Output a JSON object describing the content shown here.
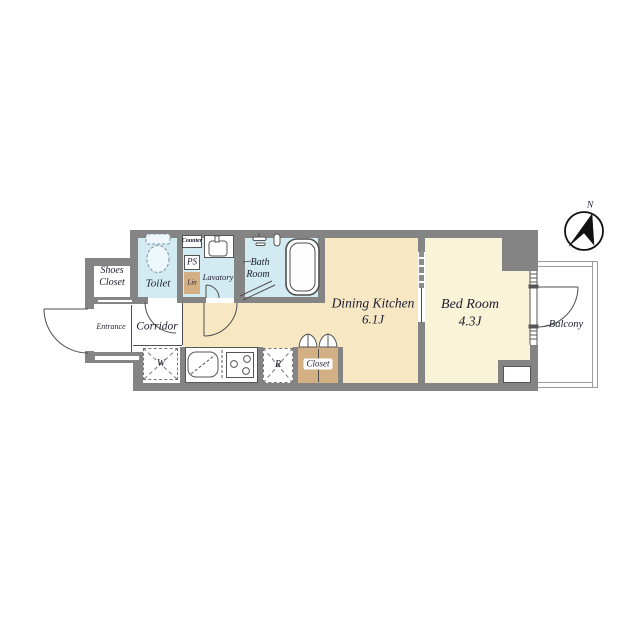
{
  "compass": {
    "north": "N"
  },
  "rooms": {
    "shoes_closet": {
      "line1": "Shoes",
      "line2": "Closet"
    },
    "toilet": {
      "label": "Toilet"
    },
    "counter": {
      "label": "Counter"
    },
    "pipe_space": {
      "label": "PS"
    },
    "linen": {
      "label": "Lin"
    },
    "lavatory": {
      "label": "Lavatory"
    },
    "bath_room": {
      "line1": "Bath",
      "line2": "Room"
    },
    "entrance": {
      "label": "Entrance"
    },
    "corridor": {
      "label": "Corridor"
    },
    "washer": {
      "label": "W"
    },
    "refrigerator": {
      "label": "R"
    },
    "closet": {
      "label": "Closet"
    },
    "dining_kitchen": {
      "label": "Dining Kitchen",
      "size": "6.1J"
    },
    "bed_room": {
      "label": "Bed Room",
      "size": "4.3J"
    },
    "balcony": {
      "label": "Balcony"
    }
  },
  "colors": {
    "wall": "#848484",
    "wet_area": "#d2eaf2",
    "dining_kitchen": "#f7e7c3",
    "bed_room": "#f9f3d7",
    "wood": "#d2b083"
  }
}
